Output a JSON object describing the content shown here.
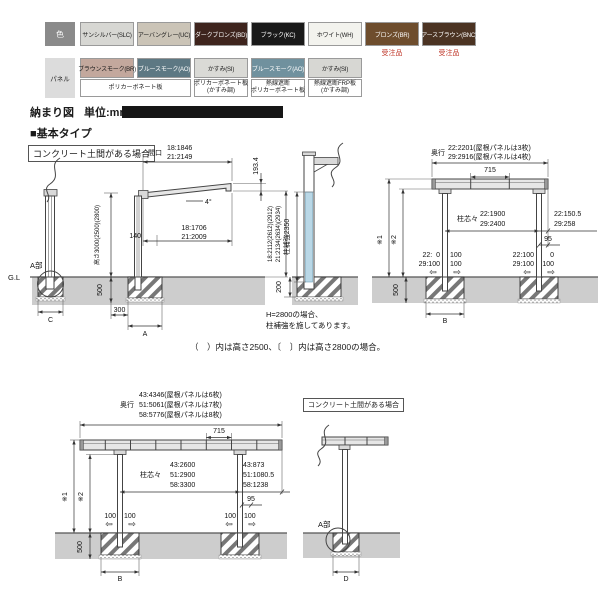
{
  "palette": {
    "order_red": "#c0392b",
    "ground": "#cdcdcd",
    "pillar_blue": "#b9d7e6"
  },
  "color_table": {
    "color_row_label": "色",
    "panel_row_label": "パネル",
    "colors": [
      {
        "label": "サンシルバー(SLC)",
        "bg": "#d7d7d3",
        "fg": "#1a1a1a",
        "note": ""
      },
      {
        "label": "アーバングレー(UC)",
        "bg": "#cbc4b7",
        "fg": "#1a1a1a",
        "note": ""
      },
      {
        "label": "ダークブロンズ(BD)",
        "bg": "#3e241d",
        "fg": "#ffffff",
        "note": ""
      },
      {
        "label": "ブラック(KC)",
        "bg": "#191919",
        "fg": "#ffffff",
        "note": ""
      },
      {
        "label": "ホワイト(WH)",
        "bg": "#f3f3ee",
        "fg": "#1a1a1a",
        "note": ""
      },
      {
        "label": "ブロンズ(BR)",
        "bg": "#6e4d2d",
        "fg": "#ffffff",
        "note": "受注品"
      },
      {
        "label": "アースブラウン(BNC)",
        "bg": "#4b3322",
        "fg": "#ffffff",
        "note": "受注品"
      }
    ],
    "panels": [
      {
        "label": "ブラウンスモーク(BR)",
        "bg": "#c3a89d",
        "fg": "#1a1a1a"
      },
      {
        "label": "ブルースモーク(AO)",
        "bg": "#5d7883",
        "fg": "#ffffff"
      },
      {
        "label": "かすみ(SI)",
        "bg": "#dadad6",
        "fg": "#1a1a1a"
      },
      {
        "label": "ブルースモーク(AO)",
        "bg": "#70919e",
        "fg": "#ffffff"
      },
      {
        "label": "かすみ(SI)",
        "bg": "#d7d7d3",
        "fg": "#1a1a1a"
      }
    ],
    "materials": [
      {
        "line1": "ポリカーボネート板",
        "line2": ""
      },
      {
        "line1": "ポリカーボネート板",
        "line2": "(かすみ調)"
      },
      {
        "line1": "熱線遮断",
        "line2": "ポリカーボネート板"
      },
      {
        "line1": "熱線遮断FRP板",
        "line2": "(かすみ調)"
      }
    ]
  },
  "header": {
    "title": "納まり図",
    "unit": "単位:mm",
    "section": "■基本タイプ"
  },
  "notes": {
    "concrete_case": "コンクリート土間がある場合",
    "bracket_note": "（　）内は高さ2500、〔　〕内は高さ2800の場合。",
    "reinforce_note1": "H=2800の場合、",
    "reinforce_note2": "柱補強を施してあります。"
  },
  "side_view": {
    "width_label": "間口",
    "width_18": "18:1846",
    "width_21": "21:2149",
    "slope": "4°",
    "panel_18": "18:1706",
    "panel_21": "21:2009",
    "dim_140": "140",
    "height_note": "高さ3000(2500)(2800)",
    "dim_500": "500",
    "dim_300": "300",
    "dim_A": "A",
    "dim_C": "C",
    "gl": "G.L",
    "a_part": "A部",
    "front_height": "193.4",
    "eave_18": "18:2112(2612)(2912)",
    "eave_21": "21:2134(2634)(2934)"
  },
  "pillar": {
    "reinforce": "柱補強2350",
    "dim_200": "200"
  },
  "front_small": {
    "depth_label": "奥行",
    "depth_22": "22:2201(屋根パネルは3枚)",
    "depth_29": "29:2916(屋根パネルは4枚)",
    "pitch_715": "715",
    "span_label": "柱芯々",
    "span_22": "22:1900",
    "span_29": "29:2400",
    "over_22": "22:150.5",
    "over_29": "29:258",
    "dim_95": "95",
    "star1": "※1",
    "star2": "※2",
    "left_l1": "22:  0",
    "left_l1r": "100",
    "left_l2": "29:100",
    "left_l2r": "100",
    "right_l1": "22:100",
    "right_l1r": "0",
    "right_l2": "29:100",
    "right_l2r": "100",
    "dim_500": "500",
    "dim_B": "B"
  },
  "front_large": {
    "depth_label": "奥行",
    "depth_43": "43:4346(屋根パネルは6枚)",
    "depth_51": "51:5061(屋根パネルは7枚)",
    "depth_58": "58:5776(屋根パネルは8枚)",
    "pitch_715": "715",
    "span_label": "柱芯々",
    "span_43": "43:2600",
    "span_51": "51:2900",
    "span_58": "58:3300",
    "over_43": "43:873",
    "over_51": "51:1080.5",
    "over_58": "58:1238",
    "dim_95": "95",
    "star1": "※1",
    "star2": "※2",
    "dim_100": "100",
    "dim_500": "500",
    "dim_B": "B"
  },
  "concrete_detail": {
    "a_part": "A部",
    "dim_D": "D"
  },
  "icons": {
    "arrow_hollow_left": "⇦",
    "arrow_hollow_right": "⇨"
  }
}
